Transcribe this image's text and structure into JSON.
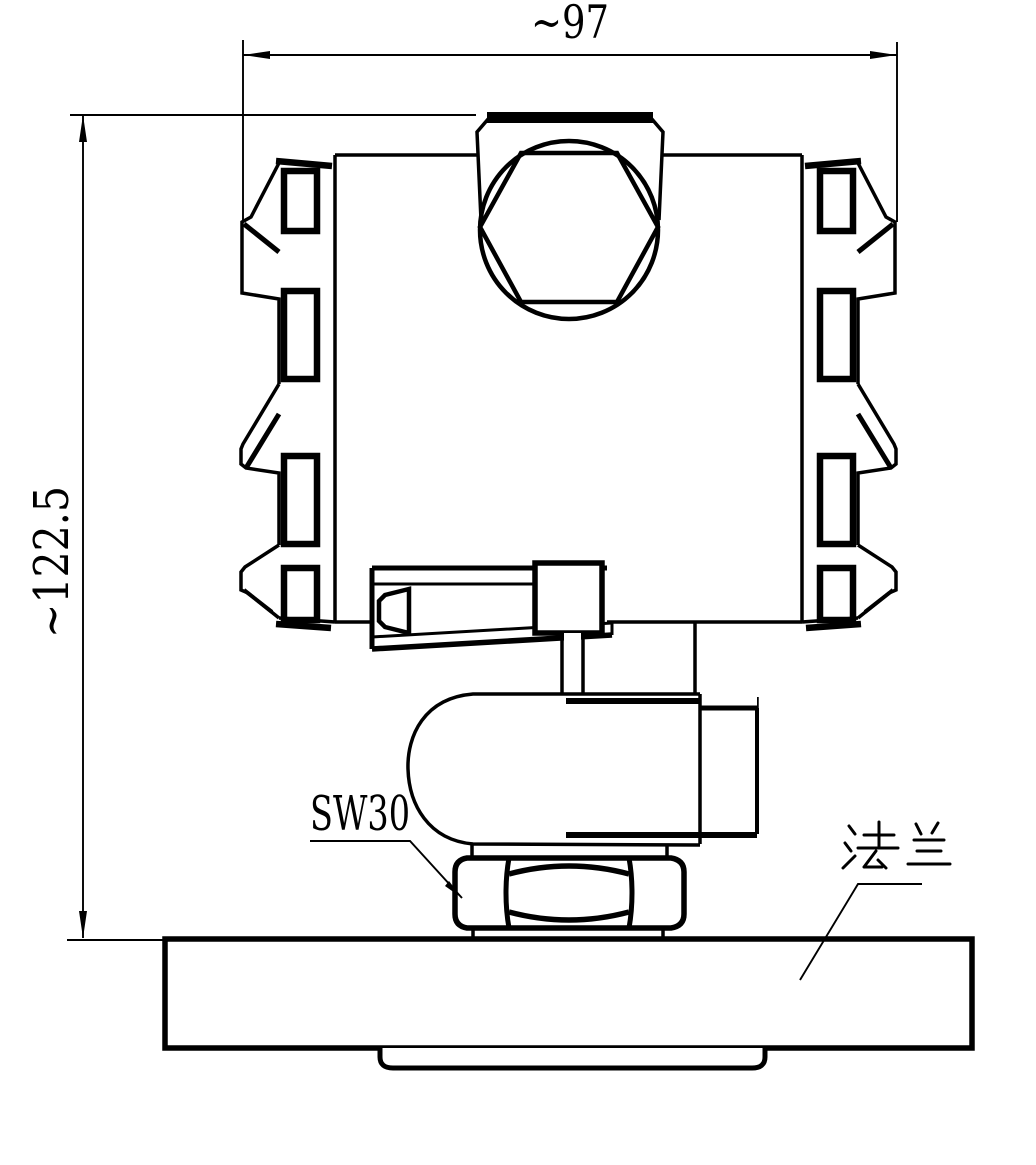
{
  "drawing": {
    "type": "engineering-dimension-drawing",
    "subject": "flange-mounted pressure transmitter, front view",
    "colors": {
      "ink": "#000000",
      "paper": "#ffffff"
    },
    "dimensions": {
      "overall_width": {
        "text": "~97",
        "orientation": "horizontal"
      },
      "overall_height": {
        "text": "~122.5",
        "orientation": "vertical"
      }
    },
    "labels": {
      "wrench_size": {
        "text": "SW30",
        "points_to": "hex nut"
      },
      "flange": {
        "text": "法兰",
        "points_to": "flange plate"
      }
    }
  }
}
